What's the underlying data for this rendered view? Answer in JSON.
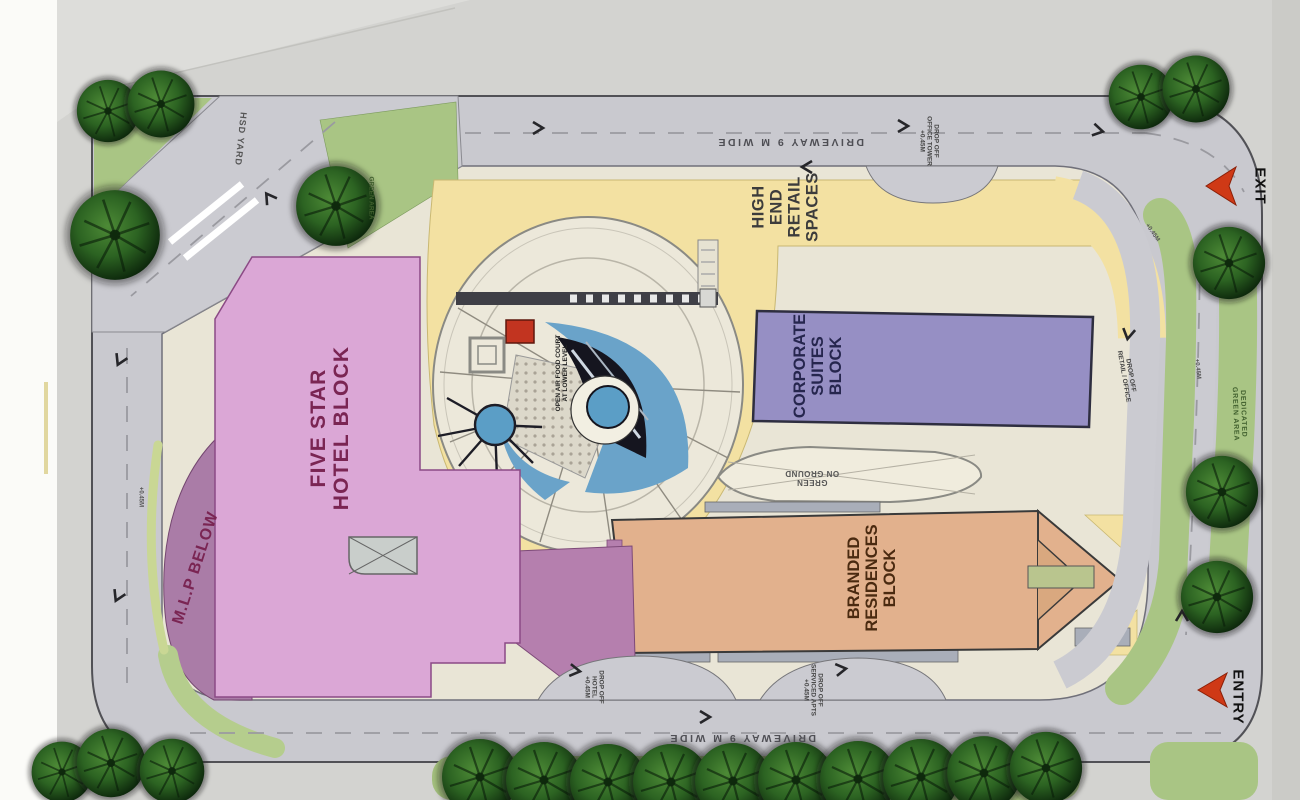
{
  "labels": {
    "hotel": "FIVE STAR\nHOTEL BLOCK",
    "mlp": "M.L.P BELOW",
    "retail": "HIGH\nEND\nRETAIL\nSPACES",
    "corporate": "CORPORATE\nSUITES\nBLOCK",
    "residences": "BRANDED\nRESIDENCES\nBLOCK",
    "driveway": "DRIVEWAY 9 M WIDE",
    "hsd_yard": "HSD YARD",
    "exit": "EXIT",
    "entry": "ENTRY",
    "dropoff_office_tower": "DROP OFF\nOFFICE TOWER\n+0.45M",
    "dropoff_retail_office": "DROP OFF\nRETAIL / OFFICE",
    "dedicated_green_area": "DEDICATED GREEN AREA",
    "dropoff_hotel": "DROP OFF\nHOTEL\n+0.45M",
    "dropoff_serviced_apts": "DROP OFF\nSERVICED APTS\n+0.45M",
    "food_court": "OPEN AIR FOOD COURT\nAT LOWER LEVEL",
    "green_on_ground": "GREEN\nON GROUND",
    "green_area": "GREEN AREA",
    "level_marker": "+0.45M"
  },
  "colors": {
    "hotel_block": "#dba7d6",
    "mlp_strip": "#aa7ca7",
    "retail_band": "#f3e1a2",
    "corporate_block": "#968fc4",
    "residences_block": "#e2b18d",
    "green": "#a9c584",
    "road": "#c9c9cf",
    "sand": "#e9e5d6",
    "water_blue": "#6aa3c9",
    "accent_red": "#cf3916"
  }
}
